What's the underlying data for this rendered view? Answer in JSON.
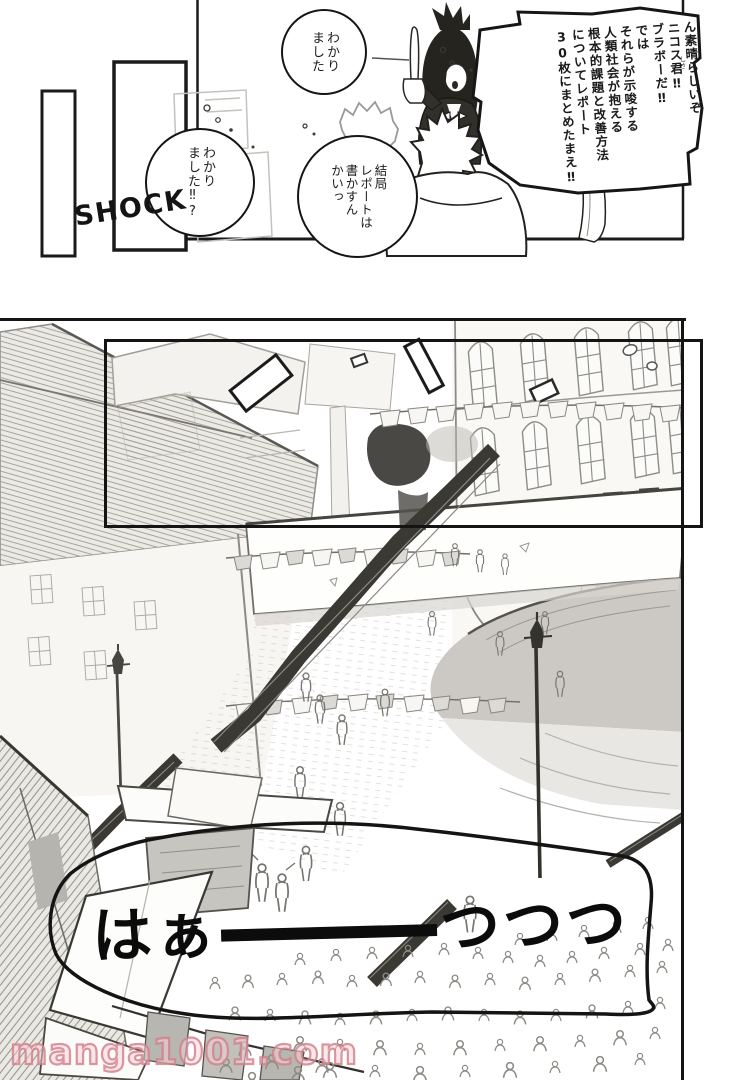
{
  "page": {
    "watermark_text": "manga1001.com"
  },
  "top_panel": {
    "sfx": "SHOCK",
    "bubble_wakarimashita_1": "わかり\nました",
    "bubble_wakarimashita_2": "わかり\nました‼?",
    "bubble_kekkyoku": "結局\nレポートは\n書かすん\nかいっ",
    "bubble_teacher": "ん素晴らしいぞ\nニコス君‼\nブラボーだ‼\nでは\nそれらが示唆する\n人類社会が抱える\n根本的課題と改善方法\nについてレポート\n30枚にまとめたまえ‼",
    "teacher_furigana": "しさ"
  },
  "main_panel": {
    "sigh_prefix": "はぁ",
    "sigh_suffix": "つつつ",
    "sigh_full_text": "はぁ――――つつつ"
  }
}
